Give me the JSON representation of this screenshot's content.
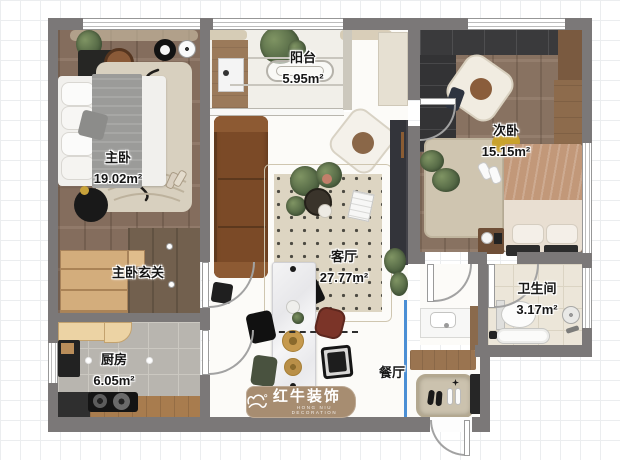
{
  "plan": {
    "rooms": {
      "master_bedroom": {
        "name": "主卧",
        "area": "19.02m²"
      },
      "master_hall": {
        "name": "主卧玄关",
        "area": ""
      },
      "balcony": {
        "name": "阳台",
        "area": "5.95m²"
      },
      "living_room": {
        "name": "客厅",
        "area": "27.77m²"
      },
      "dining_room": {
        "name": "餐厅",
        "area": ""
      },
      "kitchen": {
        "name": "厨房",
        "area": "6.05m²"
      },
      "second_bedroom": {
        "name": "次卧",
        "area": "15.15m²"
      },
      "bathroom": {
        "name": "卫生间",
        "area": "3.17m²"
      }
    },
    "watermark": {
      "brand": "红牛装饰",
      "tagline": "HONG NIU DECORATION"
    },
    "colors": {
      "wall": "#7b7878",
      "wood_floor": "#8b7362",
      "kitchen_tile": "#b8b5af",
      "bath_tile": "#ece6d9",
      "sofa_leather": "#7b4a27",
      "watermark_tan": "#a78d71",
      "glass_partition_blue": "#4b8fd5"
    }
  }
}
